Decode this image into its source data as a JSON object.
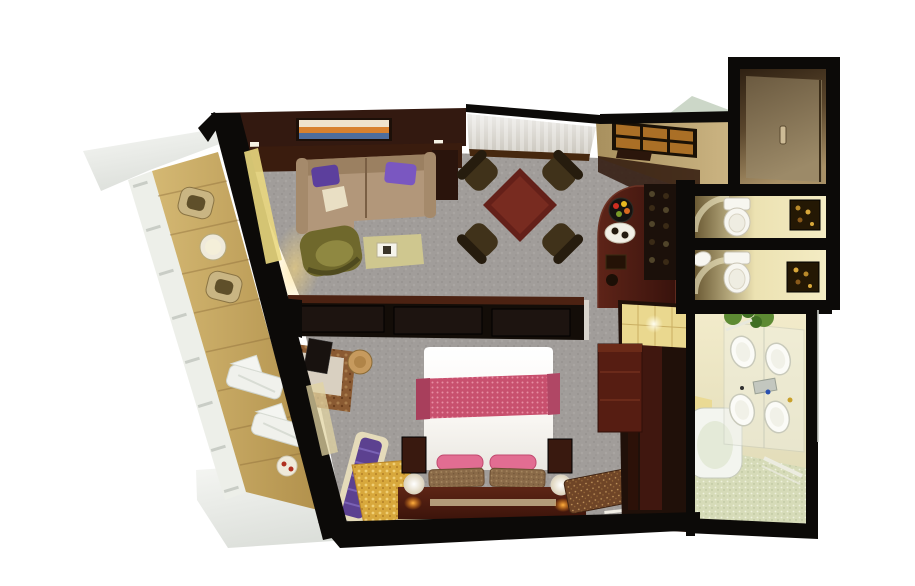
{
  "scene": {
    "type": "3d-floor-plan-rendering",
    "description": "Aerial cutaway 3D floor plan of a suite with balcony, living-dining room, bar, entry hall, two water closets, bathroom, wardrobe and bedroom",
    "rooms": [
      "balcony",
      "living-room",
      "dining-area",
      "entry-foyer",
      "entry-hall",
      "wc-upper",
      "wc-lower",
      "bathroom",
      "wardrobe",
      "bar-kitchenette",
      "bedroom"
    ]
  },
  "colors": {
    "background": "#ffffff",
    "wall": "#0c0a08",
    "wallBrown": "#331910",
    "carpet": "#a19d9a",
    "balconyFloor": "#c7a75e",
    "deck": "#edefe9",
    "wicker": "#c9b583",
    "wickerInner": "#5f4f2a",
    "loungeTable": "#efeadb",
    "lounger": "#f0f1ec",
    "sofa": "#b2977a",
    "sofaArm": "#a58a6b",
    "sofaBack": "#8f7355",
    "pillowPurpleA": "#5c3f9d",
    "pillowPurpleB": "#7a57c1",
    "throw": "#e9dfc4",
    "chairOlive": "#6f682c",
    "chairOliveSeat": "#8f8841",
    "ottoman": "#cfc78f",
    "tray": "#f5f3ea",
    "diningTable": "#642019",
    "diningChair": "#40321a",
    "diningChairBack": "#261c0e",
    "threshold": "#46280f",
    "consoleWood": "#3a1c0e",
    "paintingOrange": "#d8812f",
    "paintingBlue": "#4e6d9d",
    "paintingCream": "#efe3cd",
    "fixtureFrame": "#1a1106",
    "fixtureAmber": "#aa6f26",
    "greenGlass": "#c9d5c5",
    "barCounter": "#4b1e14",
    "shelf": "#1b100a",
    "plate": "#f2efe6",
    "fruitRed": "#cf2d20",
    "fruitYellow": "#e8b820",
    "fruitGreen": "#7a9a28",
    "doorHandle": "#cdbb96",
    "toilet": "#f7f6f0",
    "artFrame": "#241804",
    "bathFloor": "#d6dbb8",
    "tub": "#f3f5ef",
    "sink": "#fbfbf7",
    "chrome": "#c3c7bf",
    "plant": "#5d8a33",
    "plantDark": "#416f24",
    "tileYellow": "#ead88f",
    "wardrobe": "#201009",
    "wardrobeInner": "#471910",
    "dresser": "#561d12",
    "divider": "#130d08",
    "dividerTop": "#4c2212",
    "bolster": "#e26d92",
    "runnerEdge": "#a83f5c",
    "nightstand": "#39190f",
    "platformEdge": "#cbb790",
    "chaisePurple": "#5c4190",
    "chaiseFrame": "#e5dbba",
    "desk": "#d9d0c1",
    "stool": "#c69a5e",
    "tv": "#18120f",
    "glassDoor": "#ead87f",
    "glassDoor2": "#e2d4a2",
    "foyerDark": "#2f170c",
    "greyLine": "#c9ccc6"
  }
}
